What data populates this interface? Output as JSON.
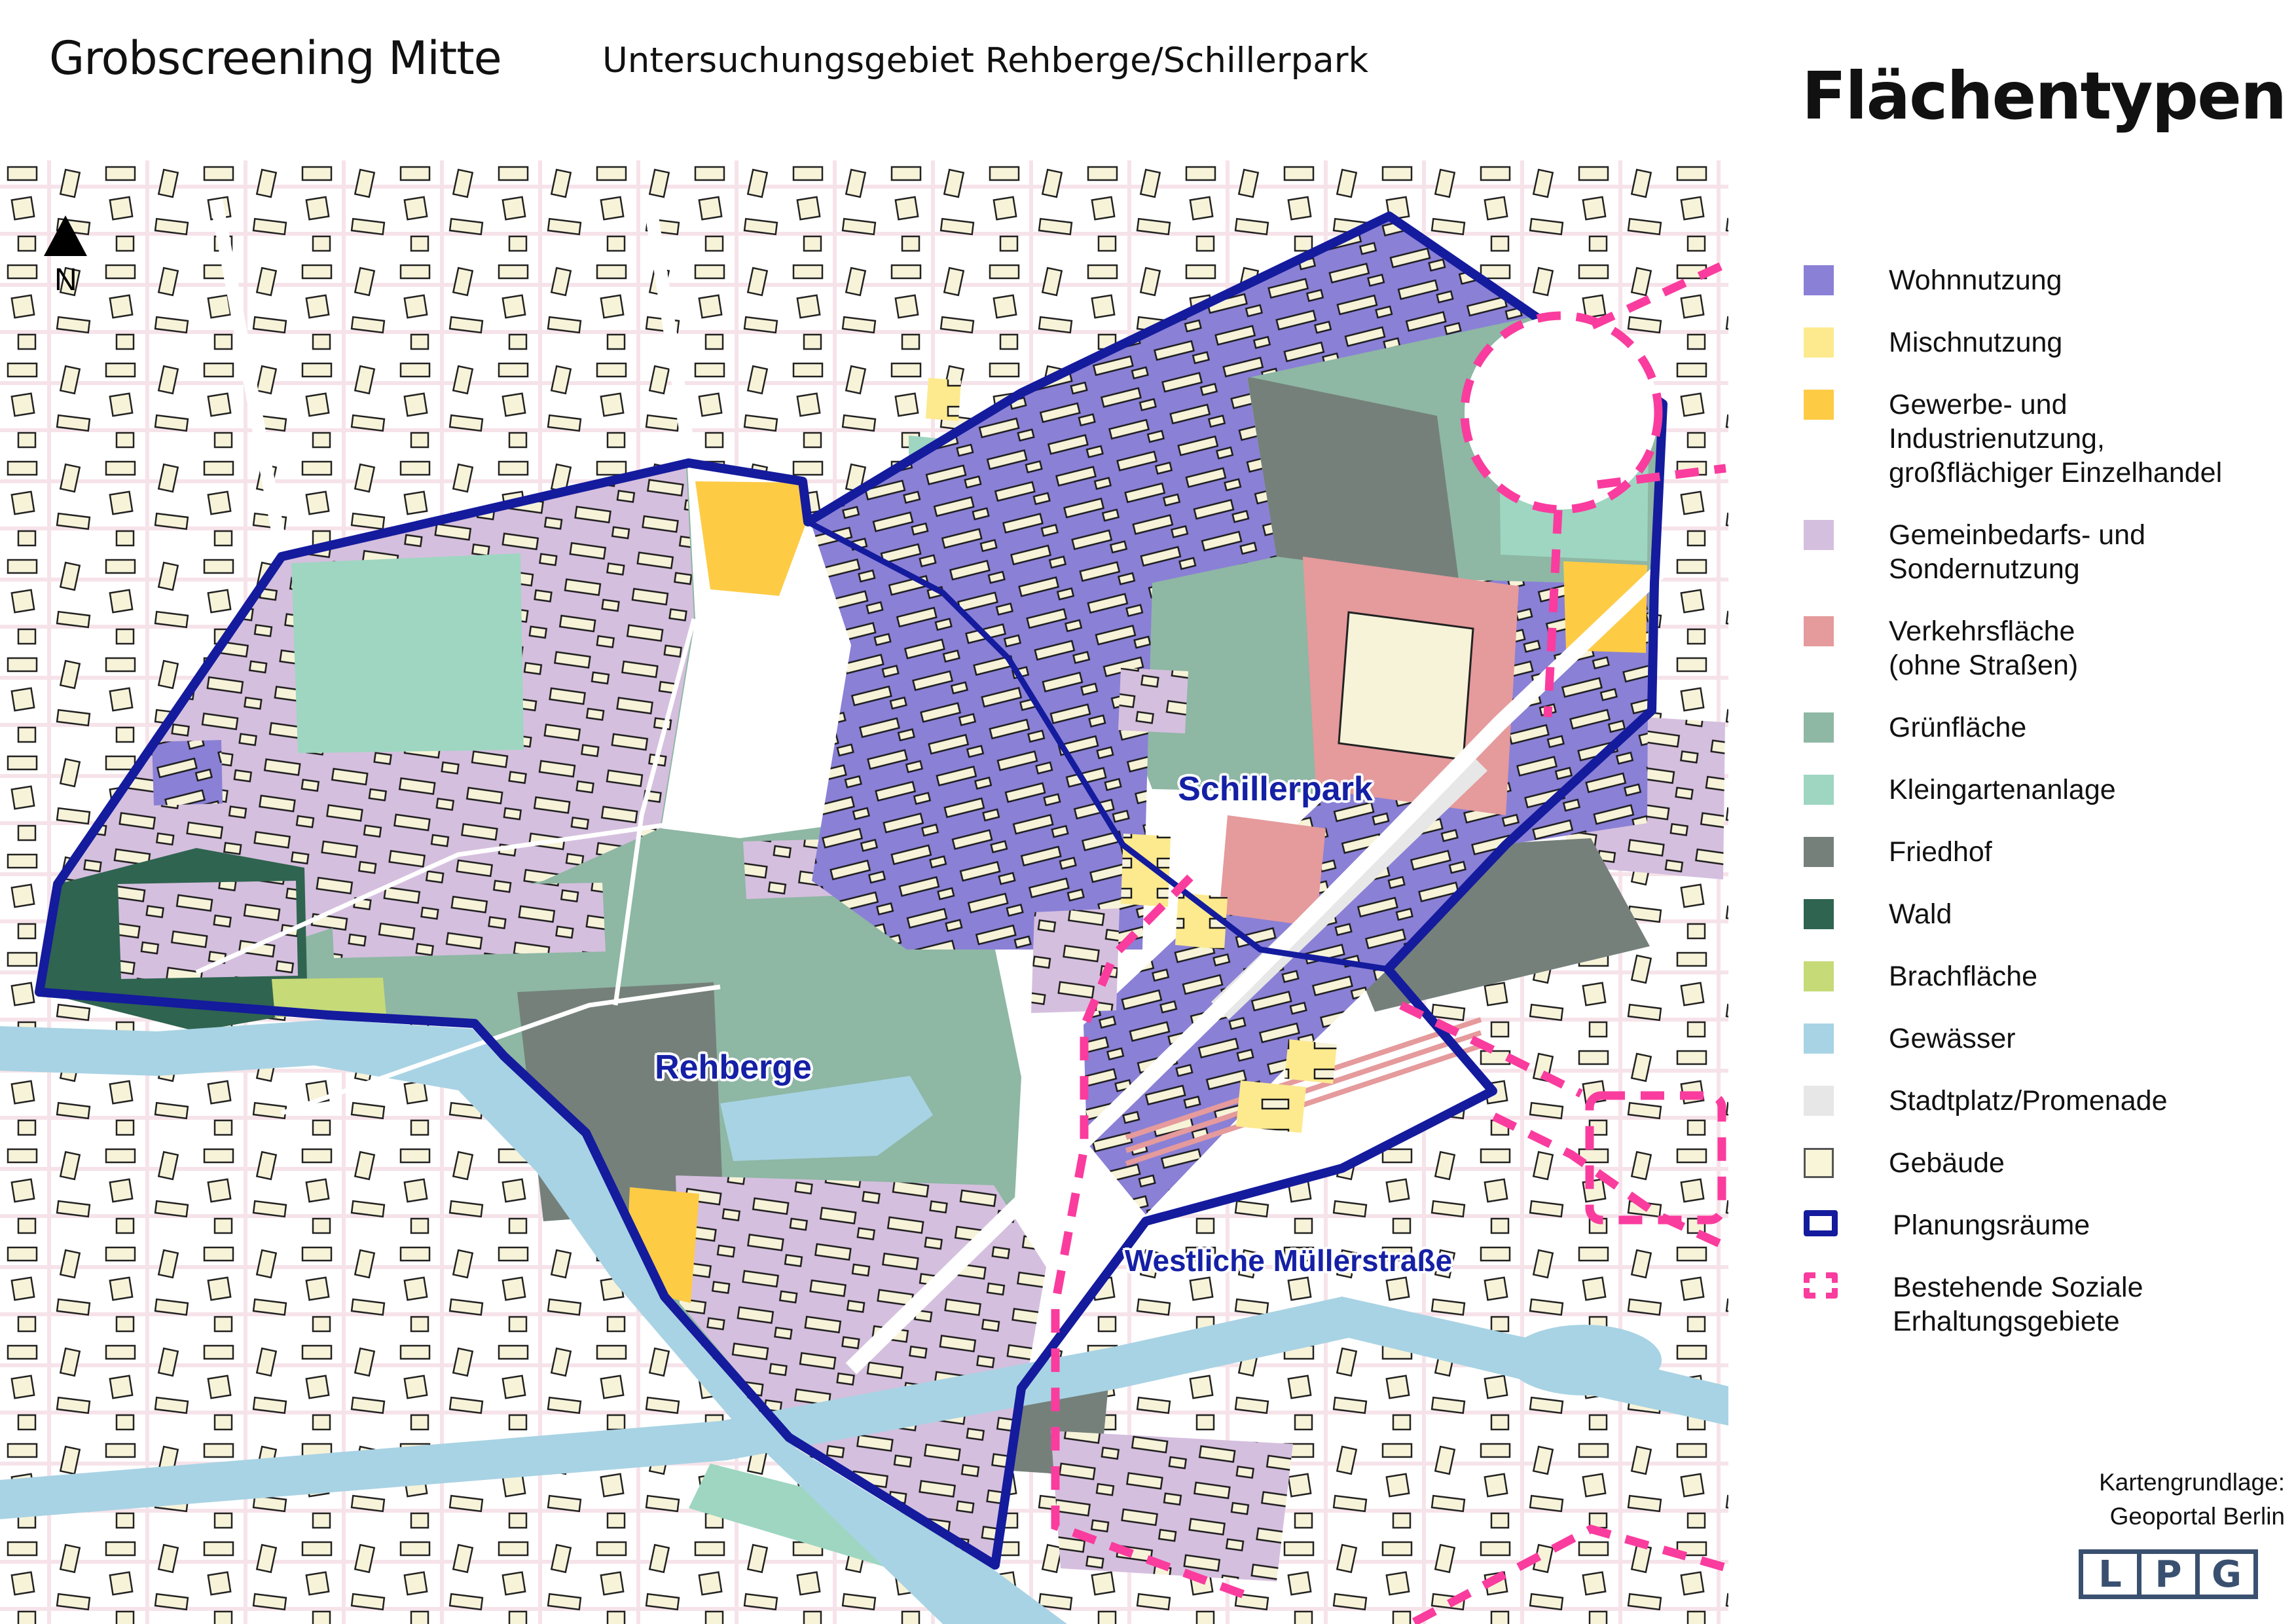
{
  "header": {
    "title": "Grobscreening Mitte",
    "subtitle": "Untersuchungsgebiet Rehberge/Schillerpark"
  },
  "legend": {
    "title": "Flächentypen",
    "items": [
      {
        "label": "Wohnnutzung",
        "color": "#8a80d6",
        "type": "fill"
      },
      {
        "label": "Mischnutzung",
        "color": "#fdea8e",
        "type": "fill"
      },
      {
        "label": "Gewerbe- und\nIndustrienutzung,\ngroßflächiger Einzelhandel",
        "color": "#fecb45",
        "type": "fill"
      },
      {
        "label": "Gemeinbedarfs- und\nSondernutzung",
        "color": "#d5bfde",
        "type": "fill"
      },
      {
        "label": "Verkehrsfläche\n(ohne Straßen)",
        "color": "#e59a9c",
        "type": "fill"
      },
      {
        "label": "Grünfläche",
        "color": "#8eb7a4",
        "type": "fill"
      },
      {
        "label": "Kleingartenanlage",
        "color": "#9ed6c1",
        "type": "fill"
      },
      {
        "label": "Friedhof",
        "color": "#75807b",
        "type": "fill"
      },
      {
        "label": "Wald",
        "color": "#2f6450",
        "type": "fill"
      },
      {
        "label": "Brachfläche",
        "color": "#c6da78",
        "type": "fill"
      },
      {
        "label": "Gewässer",
        "color": "#a8d3e4",
        "type": "fill"
      },
      {
        "label": "Stadtplatz/Promenade",
        "color": "#e7e7e7",
        "type": "fill"
      },
      {
        "label": "Gebäude",
        "color": "#f8f5d8",
        "type": "building"
      },
      {
        "label": "Planungsräume",
        "color": "#141b9d",
        "type": "outline"
      },
      {
        "label": "Bestehende Soziale\nErhaltungsgebiete",
        "color": "#fa3c9e",
        "type": "dashed"
      }
    ]
  },
  "map": {
    "labels": {
      "schillerpark": "Schillerpark",
      "rehberge": "Rehberge",
      "muellerstrasse": "Westliche Müllerstraße"
    },
    "north": "N"
  },
  "credits": {
    "line1": "Kartengrundlage:",
    "line2": "Geoportal Berlin"
  },
  "logo": {
    "letters": [
      "L",
      "P",
      "G"
    ]
  },
  "colors": {
    "navy": "#141b9d",
    "pink": "#fa3c9e",
    "label-blue": "#1520a5",
    "logo-navy": "#3a5070"
  }
}
